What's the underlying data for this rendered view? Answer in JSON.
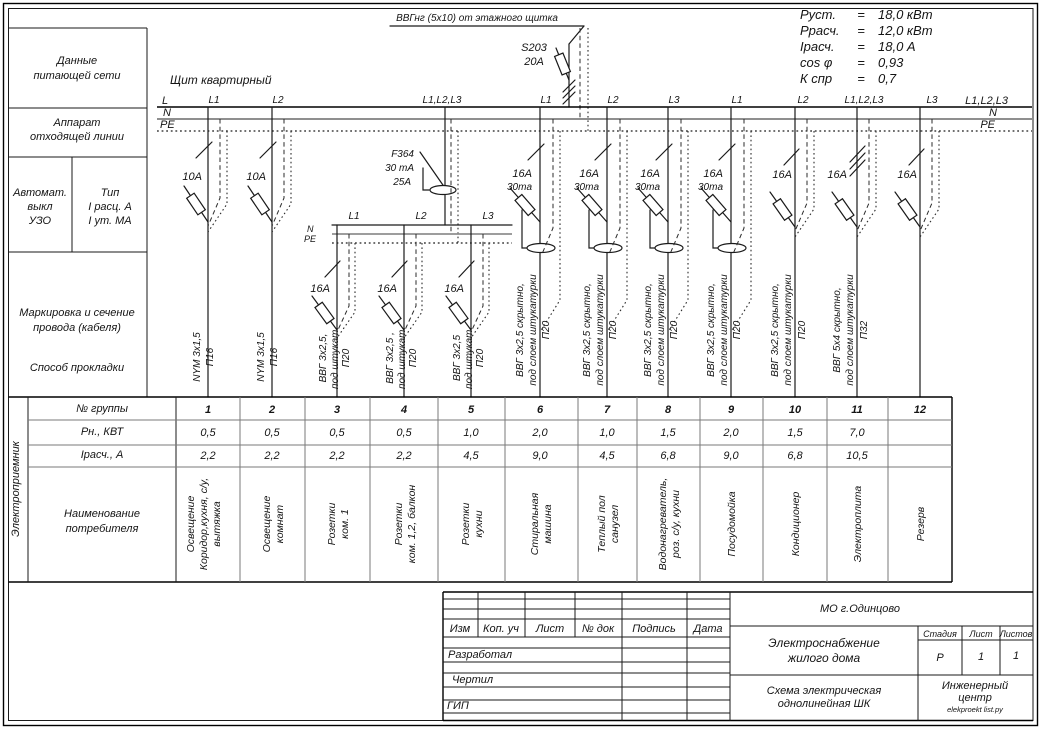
{
  "panel_title": "Щит квартирный",
  "ratings": {
    "eq": "=",
    "rows": [
      {
        "name": "Руст.",
        "value": "18,0 кВт"
      },
      {
        "name": "Ррасч.",
        "value": "12,0  кВт"
      },
      {
        "name": "Iрасч.",
        "value": "18,0  А"
      },
      {
        "name": "cos φ",
        "value": "0,93"
      },
      {
        "name": "К спр",
        "value": "0,7"
      }
    ]
  },
  "incoming": {
    "cable_label": "ВВГнг (5х10) от этажного щитка",
    "breaker_type": "S203",
    "breaker_rating": "20А"
  },
  "buses": {
    "l": "L",
    "n": "N",
    "pe": "PE",
    "right_phases": "L1,L2,L3",
    "right_n": "N",
    "right_pe": "PE"
  },
  "sub_bus": {
    "n": "N",
    "pe": "PE",
    "phases": [
      "L1",
      "L2",
      "L3"
    ]
  },
  "rcd": {
    "model": "F364",
    "leakage": "30 mA",
    "rating": "25А"
  },
  "left_panel": {
    "feed_lines": [
      "Данные",
      "питающей сети"
    ],
    "outgoing_lines": [
      "Аппарат",
      "отходящей линии"
    ],
    "breaker_lines": [
      "Автомат.",
      "выкл",
      "УЗО"
    ],
    "type_lines": [
      "Тип",
      "I расц. А",
      "I ут. МА"
    ],
    "marking_lines": [
      "Маркировка и сечение",
      "провода (кабеля)"
    ],
    "method": "Способ прокладки",
    "consumer": "Электроприемник"
  },
  "table": {
    "row_group": "№ группы",
    "row_power": "Рн., КВТ",
    "row_current": "Iрасч., А",
    "row_name_lines": [
      "Наименование",
      "потребителя"
    ]
  },
  "groups": [
    {
      "num": "1",
      "phase": "L1",
      "amp": "10А",
      "cable": [
        "NYM 3х1,5",
        "П16"
      ],
      "p": "0,5",
      "i": "2,2",
      "name": [
        "Освещение",
        "Коридор,кухня, с/у,",
        "вытяжка"
      ]
    },
    {
      "num": "2",
      "phase": "L2",
      "amp": "10А",
      "cable": [
        "NYM 3х1,5",
        "П16"
      ],
      "p": "0,5",
      "i": "2,2",
      "name": [
        "Освещение",
        "комнат"
      ]
    },
    {
      "num": "3",
      "phase": "L1",
      "amp": "16А",
      "cable": [
        "ВВГ 3х2,5,",
        "под штукат.",
        "П20"
      ],
      "p": "0,5",
      "i": "2,2",
      "name": [
        "Розетки",
        "ком. 1"
      ]
    },
    {
      "num": "4",
      "phase": "L2",
      "amp": "16А",
      "cable": [
        "ВВГ 3х2,5 ,",
        "под штукат.",
        "П20"
      ],
      "p": "0,5",
      "i": "2,2",
      "name": [
        "Розетки",
        "ком. 1,2, балкон"
      ]
    },
    {
      "num": "5",
      "phase": "L3",
      "amp": "16А",
      "cable": [
        "ВВГ 3х2,5",
        "под штукат.",
        "П20"
      ],
      "p": "1,0",
      "i": "4,5",
      "name": [
        "Розетки",
        "кухни"
      ]
    },
    {
      "num": "6",
      "phase": "L1",
      "amp": "16А",
      "diff": "30ma",
      "cable": [
        "ВВГ 3х2,5 скрытно,",
        "под слоем штукатурки",
        "П20"
      ],
      "p": "2,0",
      "i": "9,0",
      "name": [
        "Стиральная",
        "машина"
      ]
    },
    {
      "num": "7",
      "phase": "L2",
      "amp": "16А",
      "diff": "30ma",
      "cable": [
        "ВВГ 3х2,5 скрытно,",
        "под слоем штукатурки",
        "П20"
      ],
      "p": "1,0",
      "i": "4,5",
      "name": [
        "Теплый пол",
        "санузел"
      ]
    },
    {
      "num": "8",
      "phase": "L3",
      "amp": "16А",
      "diff": "30ma",
      "cable": [
        "ВВГ 3х2,5 скрытно,",
        "под слоем штукатурки",
        "П20"
      ],
      "p": "1,5",
      "i": "6,8",
      "name": [
        "Водонагреватель,",
        "роз. с/у, кухни"
      ]
    },
    {
      "num": "9",
      "phase": "L1",
      "amp": "16А",
      "diff": "30ma",
      "cable": [
        "ВВГ 3х2,5 скрытно,",
        "под слоем штукатурки",
        "П20"
      ],
      "p": "2,0",
      "i": "9,0",
      "name": [
        "Посудомойка"
      ]
    },
    {
      "num": "10",
      "phase": "L2",
      "amp": "16А",
      "cable": [
        "ВВГ 3х2,5 скрытно,",
        "под слоем штукатурки",
        "П20"
      ],
      "p": "1,5",
      "i": "6,8",
      "name": [
        "Кондиционер"
      ]
    },
    {
      "num": "11",
      "phase": "L1,L2,L3",
      "amp": "16А",
      "cable": [
        "ВВГ 5х4  скрытно,",
        "под слоем штукатурки",
        "П32"
      ],
      "p": "7,0",
      "i": "10,5",
      "name": [
        "Электроплита"
      ]
    },
    {
      "num": "12",
      "phase": "L3",
      "amp": "16А",
      "cable": [],
      "p": "",
      "i": "",
      "name": [
        "Резерв"
      ]
    }
  ],
  "title_block": {
    "cols": [
      "Изм",
      "Коп. уч",
      "Лист",
      "№ док",
      "Подпись",
      "Дата"
    ],
    "roles": [
      "Разработал",
      "Чертил",
      "ГИП"
    ],
    "org": "МО  г.Одинцово",
    "project_lines": [
      "Электроснабжение",
      "жилого дома"
    ],
    "stage_label": "Стадия",
    "sheet_label": "Лист",
    "sheets_label": "Листов",
    "stage": "Р",
    "sheet": "1",
    "sheets": "1",
    "doc_lines": [
      "Схема электрическая",
      "однолинейная ШК"
    ],
    "company_lines": [
      "Инженерный",
      "центр"
    ],
    "site": "elekproekt list.py"
  }
}
